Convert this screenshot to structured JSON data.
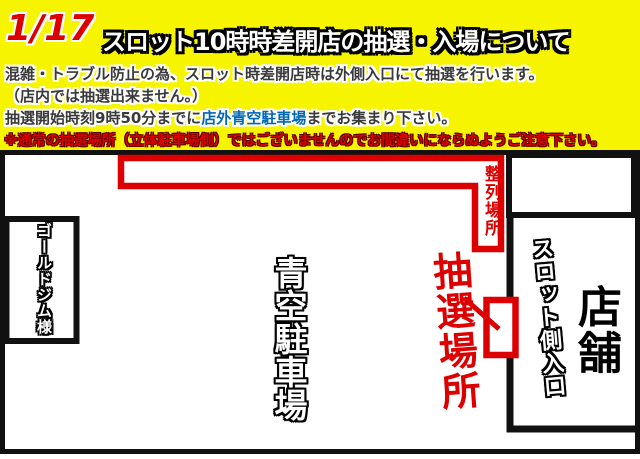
{
  "colors": {
    "background_yellow": "#f7f400",
    "red": "#dd0000",
    "blue": "#0068b7",
    "dark_text": "#3a3a3a",
    "black": "#111111"
  },
  "header": {
    "date": "1/17",
    "title": "スロット10時時差開店の抽選・入場について",
    "line1": "混雑・トラブル防止の為、スロット時差開店時は外側入口にて抽選を行います。",
    "line2": "（店内では抽選出来ません。）",
    "line3_pre": "抽選開始時刻9時50分までに",
    "line3_highlight": "店外青空駐車場",
    "line3_post": "までお集まり下さい。",
    "warning": "※通常の抽選場所（立体駐車場側）ではございませんのでお間違いにならぬようご注意下さい。"
  },
  "map": {
    "queue_area_label": "整列場所",
    "lottery_area_label": "抽選場所",
    "parking_label": "青空駐車場",
    "gym_label": "ゴールドジム様",
    "slot_entrance_label": "スロット側入口",
    "store_label": "店舗"
  }
}
